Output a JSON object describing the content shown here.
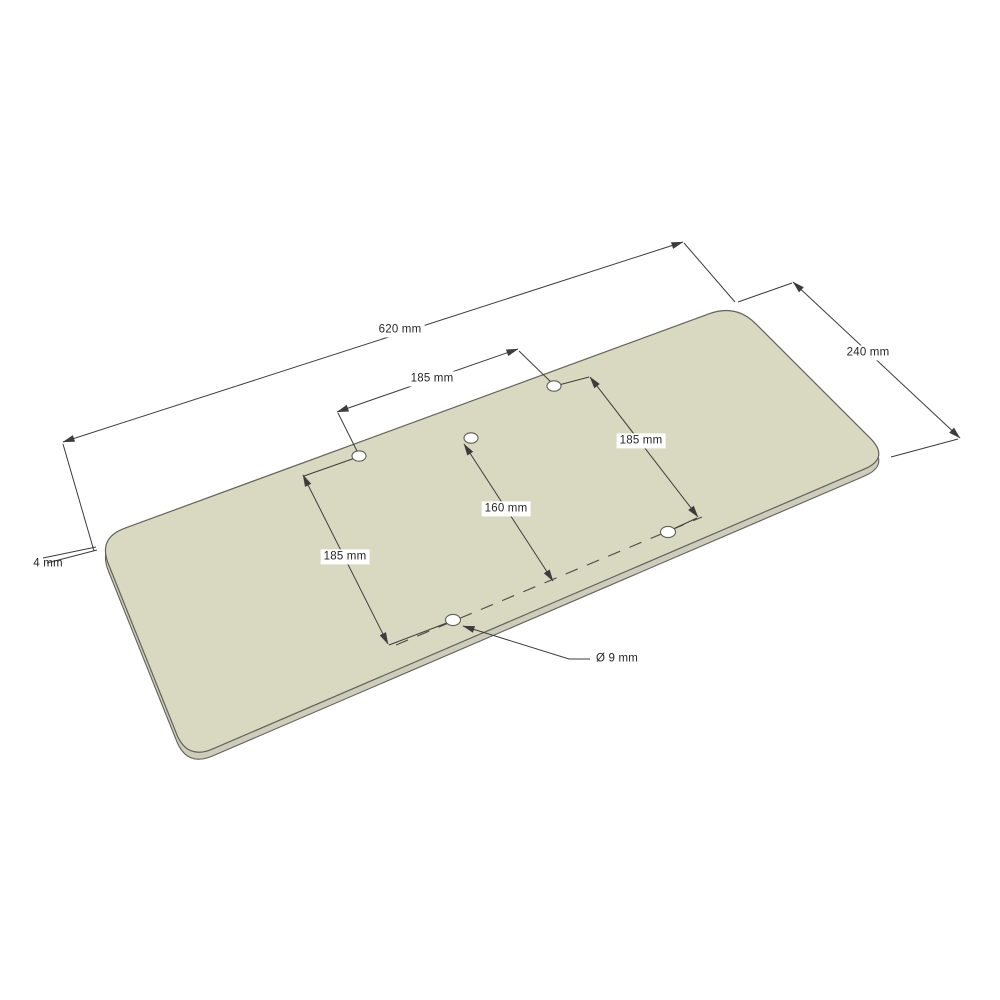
{
  "drawing": {
    "type": "isometric technical drawing",
    "subject": "rectangular plate with rounded corners and five drilled holes",
    "hole_count": 5,
    "dimensions": {
      "plate_length": "620 mm",
      "plate_width": "240 mm",
      "plate_thickness": "4 mm",
      "hole_spacing_top": "185 mm",
      "hole_spacing_right": "185 mm",
      "hole_spacing_left": "185 mm",
      "hole_row_offset": "160 mm",
      "hole_diameter": "Ø 9 mm"
    },
    "colors": {
      "plate_top": "#d9d8c1",
      "plate_side": "#cecdbb",
      "outline": "#62625a",
      "dimension_lines": "#3c3c3c",
      "background": "#ffffff"
    }
  }
}
